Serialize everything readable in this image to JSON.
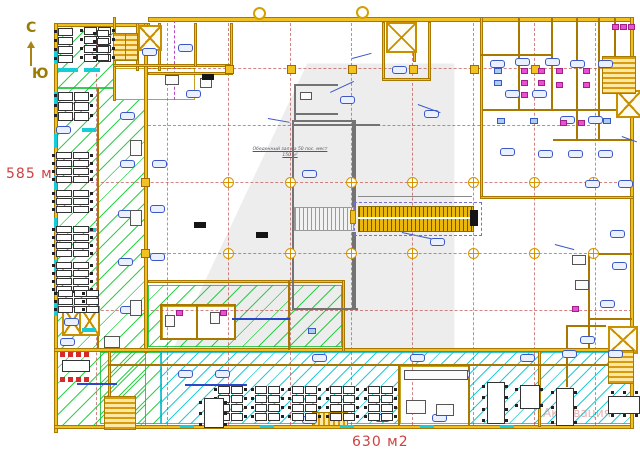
{
  "labels": {
    "compass_north": "С",
    "compass_south": "Ю",
    "area_left": "585 м2",
    "area_bottom": "630 м2",
    "center_room_line1": "Обеденный зал на 50 пос. мест",
    "center_room_line2": "150 м²",
    "watermark_estate": "4 ESTATE",
    "watermark_activation": "Активация"
  },
  "colors": {
    "wall": "#f0c020",
    "wall_edge": "#a87800",
    "hatch_green": "#0ac82d",
    "hatch_cyan": "#00c3cd",
    "grid_red": "#ba4444",
    "label_red": "#cf4040",
    "chip_blue": "#3a57c8",
    "fixture_pink": "#ea4fd2",
    "compass_olive": "#9a7d00"
  },
  "plan": {
    "hatch_green": [
      [
        57,
        26,
        57,
        62
      ],
      [
        57,
        88,
        89,
        338
      ],
      [
        148,
        285,
        194,
        62
      ],
      [
        100,
        352,
        62,
        72
      ]
    ],
    "hatch_cyan": [
      [
        160,
        352,
        472,
        72
      ]
    ],
    "white_rooms": [
      [
        162,
        306,
        74,
        34
      ],
      [
        400,
        366,
        70,
        58
      ],
      [
        115,
        68,
        80,
        32
      ]
    ],
    "walls_yellow": [
      [
        148,
        17,
        484,
        5
      ],
      [
        54,
        23,
        96,
        4
      ],
      [
        54,
        23,
        4,
        410
      ],
      [
        54,
        425,
        580,
        4
      ],
      [
        630,
        17,
        4,
        412
      ],
      [
        144,
        23,
        4,
        330
      ],
      [
        97,
        88,
        2,
        262
      ],
      [
        113,
        17,
        3,
        84
      ],
      [
        136,
        23,
        3,
        48
      ],
      [
        158,
        23,
        3,
        48
      ],
      [
        113,
        64,
        120,
        3
      ],
      [
        194,
        23,
        3,
        44
      ],
      [
        230,
        23,
        3,
        52
      ],
      [
        148,
        72,
        84,
        3
      ],
      [
        382,
        22,
        3,
        58
      ],
      [
        428,
        22,
        3,
        58
      ],
      [
        382,
        78,
        49,
        3
      ],
      [
        413,
        22,
        3,
        40
      ],
      [
        480,
        17,
        3,
        182
      ],
      [
        480,
        196,
        154,
        3
      ],
      [
        518,
        17,
        2,
        94
      ],
      [
        551,
        17,
        2,
        94
      ],
      [
        576,
        17,
        2,
        124
      ],
      [
        598,
        17,
        2,
        124
      ],
      [
        480,
        54,
        73,
        2
      ],
      [
        483,
        109,
        149,
        2
      ],
      [
        553,
        139,
        79,
        2
      ],
      [
        614,
        17,
        2,
        40
      ],
      [
        588,
        253,
        2,
        95
      ],
      [
        588,
        253,
        44,
        2
      ],
      [
        588,
        318,
        44,
        2
      ],
      [
        566,
        325,
        2,
        62
      ],
      [
        566,
        325,
        40,
        2
      ],
      [
        108,
        348,
        3,
        79
      ],
      [
        398,
        364,
        2,
        62
      ],
      [
        468,
        364,
        2,
        62
      ],
      [
        538,
        348,
        3,
        79
      ],
      [
        108,
        364,
        524,
        2
      ],
      [
        54,
        348,
        578,
        4
      ],
      [
        148,
        280,
        196,
        3
      ],
      [
        342,
        280,
        3,
        72
      ],
      [
        160,
        304,
        76,
        2
      ],
      [
        160,
        304,
        2,
        36
      ],
      [
        234,
        304,
        2,
        36
      ],
      [
        160,
        338,
        76,
        2
      ],
      [
        196,
        304,
        2,
        36
      ],
      [
        288,
        280,
        2,
        70
      ]
    ],
    "walls_gray": [
      [
        292,
        120,
        2,
        190
      ],
      [
        352,
        120,
        4,
        92
      ],
      [
        292,
        120,
        64,
        2
      ],
      [
        292,
        308,
        66,
        2
      ],
      [
        294,
        84,
        2,
        38
      ],
      [
        294,
        84,
        44,
        2
      ],
      [
        294,
        113,
        44,
        2
      ],
      [
        294,
        124,
        86,
        2
      ],
      [
        352,
        232,
        4,
        78
      ]
    ],
    "walls_blue": [
      [
        77,
        383,
        40,
        2
      ],
      [
        185,
        384,
        62,
        2
      ],
      [
        232,
        318,
        58,
        2
      ]
    ],
    "grid_v": [
      [
        96,
        24,
        425
      ],
      [
        167,
        18,
        425
      ],
      [
        228,
        18,
        425
      ],
      [
        290,
        18,
        425
      ],
      [
        351,
        18,
        425
      ],
      [
        412,
        18,
        425
      ],
      [
        473,
        18,
        425
      ],
      [
        534,
        18,
        425
      ],
      [
        595,
        18,
        425
      ]
    ],
    "grid_h": [
      [
        68,
        148,
        632
      ],
      [
        125,
        148,
        590
      ],
      [
        182,
        56,
        632
      ],
      [
        253,
        148,
        632
      ],
      [
        310,
        56,
        632
      ]
    ],
    "purple_v": [
      [
        174,
        20,
        100
      ]
    ],
    "squares": [
      [
        225,
        65
      ],
      [
        287,
        65
      ],
      [
        348,
        65
      ],
      [
        409,
        65
      ],
      [
        470,
        65
      ],
      [
        531,
        65
      ],
      [
        141,
        178
      ],
      [
        141,
        249
      ]
    ],
    "crosshairs": [
      [
        228,
        182
      ],
      [
        290,
        182
      ],
      [
        351,
        182
      ],
      [
        412,
        182
      ],
      [
        473,
        182
      ],
      [
        534,
        182
      ],
      [
        593,
        182
      ],
      [
        228,
        253
      ],
      [
        290,
        253
      ],
      [
        351,
        253
      ],
      [
        412,
        253
      ],
      [
        473,
        253
      ],
      [
        534,
        253
      ],
      [
        593,
        253
      ]
    ],
    "circles": [
      [
        258,
        12
      ],
      [
        361,
        11
      ]
    ],
    "elevators": [
      [
        138,
        25,
        20,
        22
      ],
      [
        386,
        22,
        27,
        27
      ],
      [
        616,
        90,
        22,
        24
      ],
      [
        608,
        326,
        26,
        24
      ],
      [
        62,
        306,
        17,
        26
      ],
      [
        79,
        306,
        17,
        26
      ]
    ],
    "stairs_v": [
      [
        113,
        33,
        11,
        26
      ],
      [
        125,
        33,
        11,
        26
      ],
      [
        104,
        396,
        30,
        32
      ],
      [
        608,
        350,
        24,
        32
      ],
      [
        602,
        56,
        32,
        36
      ]
    ],
    "stairs_h": [
      [
        312,
        412,
        34,
        12
      ]
    ],
    "desk_clusters": [
      [
        58,
        28,
        1,
        4,
        16,
        9
      ],
      [
        84,
        27,
        2,
        4,
        14,
        9
      ],
      [
        97,
        30,
        1,
        4,
        13,
        8
      ],
      [
        58,
        92,
        2,
        3,
        16,
        10
      ],
      [
        56,
        152,
        2,
        4,
        17,
        8
      ],
      [
        56,
        190,
        2,
        3,
        17,
        8
      ],
      [
        56,
        226,
        2,
        4,
        17,
        8
      ],
      [
        56,
        262,
        2,
        4,
        17,
        8
      ],
      [
        58,
        290,
        2,
        3,
        16,
        8
      ],
      [
        86,
        290,
        1,
        3,
        14,
        8
      ],
      [
        218,
        386,
        2,
        4,
        13,
        9
      ],
      [
        255,
        386,
        2,
        4,
        13,
        9
      ],
      [
        292,
        386,
        2,
        4,
        13,
        9
      ],
      [
        330,
        386,
        2,
        4,
        13,
        9
      ],
      [
        368,
        386,
        2,
        4,
        13,
        9
      ]
    ],
    "tables_v": [
      [
        487,
        382,
        16,
        40,
        4
      ],
      [
        556,
        388,
        16,
        36,
        3
      ],
      [
        204,
        398,
        18,
        28,
        3
      ],
      [
        520,
        385,
        18,
        22,
        2
      ]
    ],
    "tables_h": [
      [
        608,
        396,
        30,
        16,
        3
      ]
    ],
    "red_meeting": {
      "x": 60,
      "y": 352,
      "w": 30,
      "h": 30
    },
    "chips": [
      [
        142,
        48
      ],
      [
        178,
        44
      ],
      [
        96,
        44
      ],
      [
        120,
        112
      ],
      [
        56,
        126
      ],
      [
        120,
        160
      ],
      [
        118,
        210
      ],
      [
        118,
        258
      ],
      [
        120,
        306
      ],
      [
        64,
        318
      ],
      [
        60,
        338
      ],
      [
        152,
        160
      ],
      [
        150,
        205
      ],
      [
        150,
        253
      ],
      [
        186,
        90
      ],
      [
        302,
        170
      ],
      [
        430,
        238
      ],
      [
        392,
        66
      ],
      [
        340,
        96
      ],
      [
        424,
        110
      ],
      [
        490,
        60
      ],
      [
        515,
        58
      ],
      [
        545,
        58
      ],
      [
        570,
        60
      ],
      [
        598,
        60
      ],
      [
        505,
        90
      ],
      [
        532,
        90
      ],
      [
        560,
        116
      ],
      [
        588,
        116
      ],
      [
        500,
        148
      ],
      [
        538,
        150
      ],
      [
        568,
        150
      ],
      [
        598,
        150
      ],
      [
        585,
        180
      ],
      [
        618,
        180
      ],
      [
        610,
        230
      ],
      [
        612,
        262
      ],
      [
        600,
        300
      ],
      [
        580,
        336
      ],
      [
        178,
        370
      ],
      [
        215,
        370
      ],
      [
        312,
        354
      ],
      [
        410,
        354
      ],
      [
        455,
        370
      ],
      [
        520,
        354
      ],
      [
        562,
        350
      ],
      [
        608,
        350
      ],
      [
        302,
        416
      ],
      [
        375,
        414
      ],
      [
        432,
        414
      ],
      [
        490,
        416
      ]
    ],
    "pink": [
      [
        521,
        68
      ],
      [
        521,
        80
      ],
      [
        521,
        92
      ],
      [
        538,
        68
      ],
      [
        538,
        80
      ],
      [
        556,
        68
      ],
      [
        556,
        82
      ],
      [
        583,
        68
      ],
      [
        583,
        82
      ],
      [
        612,
        24
      ],
      [
        620,
        24
      ],
      [
        628,
        24
      ],
      [
        560,
        120
      ],
      [
        578,
        120
      ],
      [
        176,
        310
      ],
      [
        220,
        310
      ],
      [
        572,
        306
      ]
    ],
    "blue_bits": [
      [
        494,
        68,
        6,
        4
      ],
      [
        494,
        80,
        6,
        4
      ],
      [
        497,
        118,
        6,
        4
      ],
      [
        530,
        118,
        6,
        4
      ],
      [
        603,
        118,
        6,
        4
      ],
      [
        308,
        328,
        6,
        4
      ]
    ],
    "gray_bits": [
      [
        130,
        140,
        10,
        14
      ],
      [
        130,
        210,
        10,
        14
      ],
      [
        130,
        300,
        10,
        14
      ],
      [
        104,
        336,
        14,
        10
      ],
      [
        165,
        75,
        12,
        8
      ],
      [
        200,
        78,
        10,
        8
      ],
      [
        404,
        370,
        62,
        8
      ],
      [
        406,
        400,
        18,
        12
      ],
      [
        436,
        404,
        16,
        10
      ],
      [
        572,
        255,
        12,
        8
      ],
      [
        575,
        280,
        12,
        8
      ],
      [
        165,
        315,
        8,
        10
      ],
      [
        210,
        312,
        8,
        10
      ],
      [
        300,
        92,
        10,
        6
      ]
    ],
    "black_tags": [
      [
        202,
        74
      ],
      [
        194,
        222
      ],
      [
        256,
        232
      ]
    ],
    "cyan_ticks": [
      [
        54,
        50,
        3,
        14
      ],
      [
        54,
        92,
        3,
        14
      ],
      [
        54,
        134,
        3,
        14
      ],
      [
        54,
        176,
        3,
        14
      ],
      [
        54,
        218,
        3,
        14
      ],
      [
        54,
        260,
        3,
        14
      ],
      [
        54,
        302,
        3,
        14
      ],
      [
        82,
        128,
        14,
        4
      ],
      [
        82,
        228,
        14,
        4
      ],
      [
        82,
        328,
        14,
        4
      ],
      [
        58,
        68,
        20,
        4
      ],
      [
        84,
        68,
        16,
        4
      ],
      [
        180,
        425,
        14,
        3
      ],
      [
        260,
        425,
        14,
        3
      ],
      [
        340,
        425,
        14,
        3
      ],
      [
        420,
        425,
        14,
        3
      ],
      [
        500,
        425,
        14,
        3
      ]
    ],
    "leaders": [
      [
        330,
        92,
        26,
        -25
      ],
      [
        418,
        104,
        24,
        20
      ],
      [
        352,
        58,
        20,
        -15
      ],
      [
        268,
        118,
        22,
        10
      ],
      [
        402,
        232,
        30,
        12
      ],
      [
        555,
        244,
        20,
        15
      ],
      [
        622,
        136,
        16,
        20
      ]
    ],
    "escalator": {
      "outer": [
        354,
        202,
        126,
        32
      ],
      "yellow": [
        358,
        206,
        114,
        24
      ],
      "gray": [
        294,
        207,
        58,
        22
      ],
      "cap_black": [
        470,
        210,
        8,
        16
      ],
      "cap_yellow": [
        350,
        210,
        6,
        14
      ],
      "dim": [
        358,
        196,
        114,
        1
      ]
    }
  }
}
